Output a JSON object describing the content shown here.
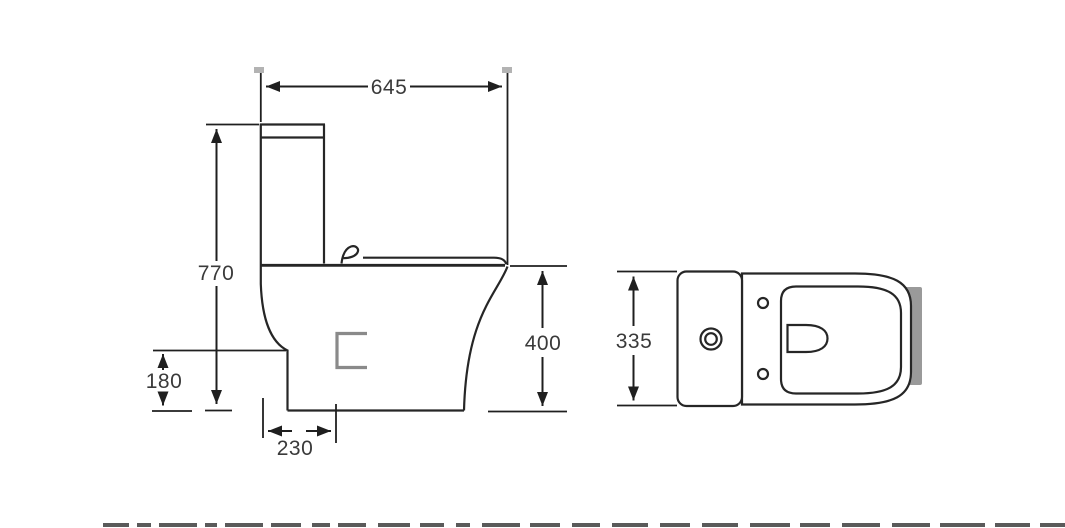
{
  "drawing": {
    "dimensions": {
      "overall_depth": "645",
      "overall_height": "770",
      "outlet_height": "180",
      "outlet_offset": "230",
      "bowl_height": "400",
      "overall_width": "335"
    },
    "colors": {
      "background": "#ffffff",
      "line": "#262626",
      "dimension_text": "#3a3a3a",
      "accent_gray": "#8a8a8a",
      "tick_gray": "#b3b3b3",
      "shadow_gray": "#9a9a9a",
      "cutoff_gray": "#5a5a5a"
    }
  }
}
